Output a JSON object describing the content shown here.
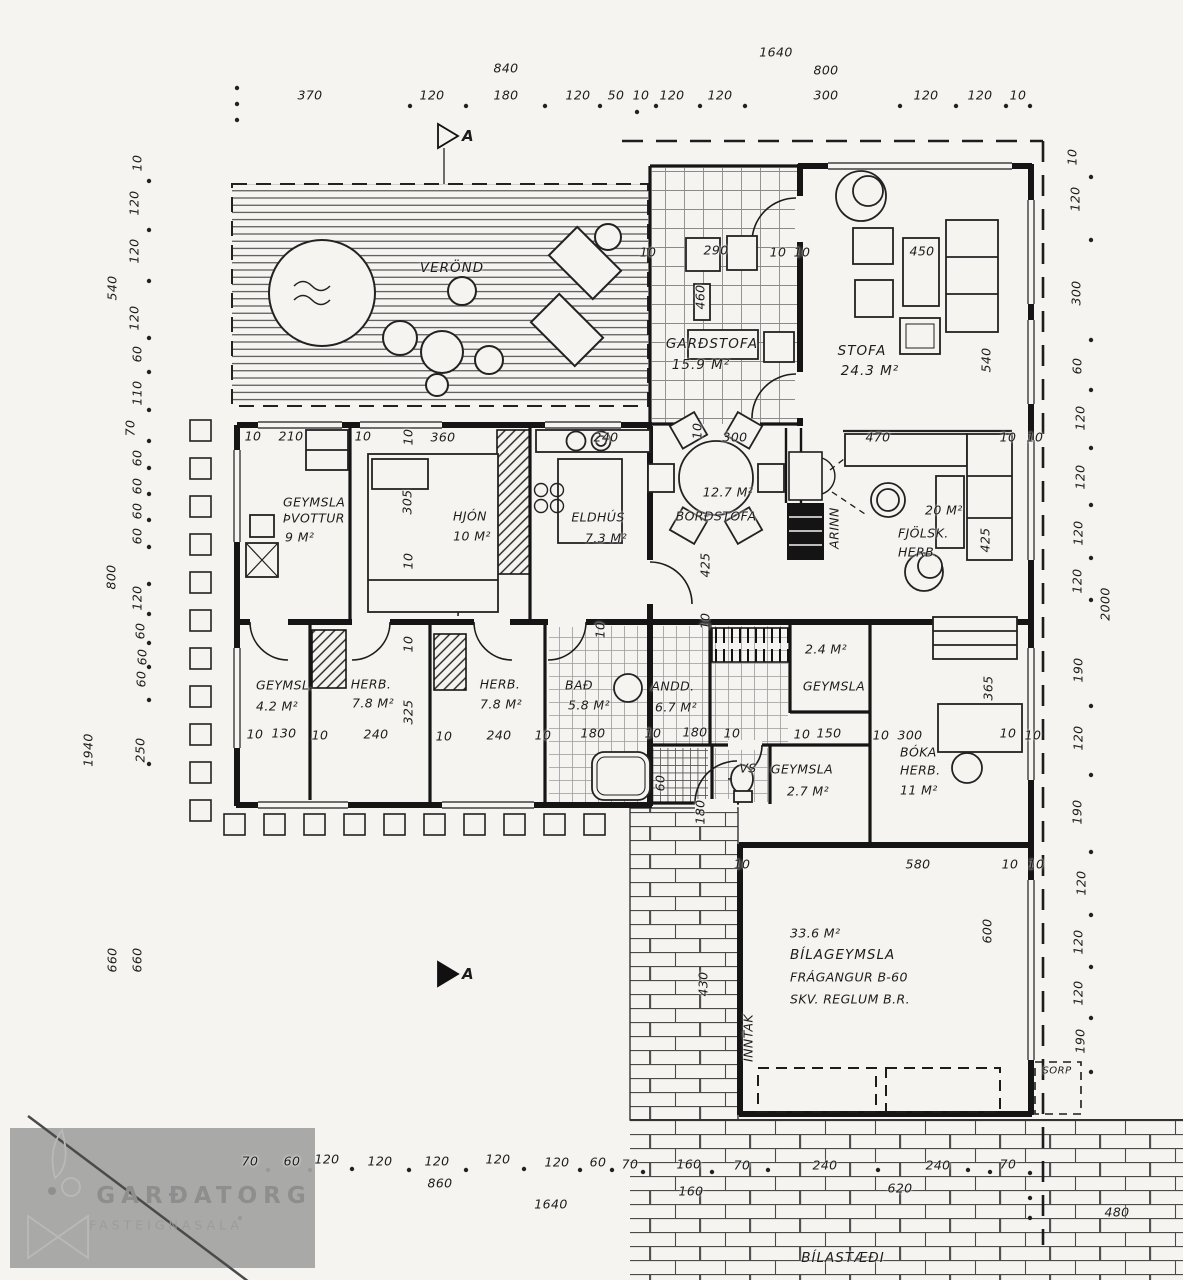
{
  "plan": {
    "section_marker": "A",
    "rooms": {
      "verond": {
        "name": "VERÖND"
      },
      "gardstofa": {
        "name": "GARÐSTOFA",
        "area": "15.9 M²"
      },
      "stofa": {
        "name": "STOFA",
        "area": "24.3 M²"
      },
      "geymsla_thvottur": {
        "name": "GEYMSLA",
        "name2": "ÞVOTTUR",
        "area": "9 M²"
      },
      "hjon": {
        "name": "HJÓN",
        "area": "10 M²"
      },
      "eldhus": {
        "name": "ELDHÚS",
        "area": "7.3 M²"
      },
      "bordstofa": {
        "name": "BORÐSTOFA",
        "area": "12.7 M²"
      },
      "arinn": {
        "name": "ARINN"
      },
      "fjolsk_herb": {
        "name": "FJÖLSK.",
        "name2": "HERB.",
        "area": "20 M²"
      },
      "geymsl_sm": {
        "name": "GEYMSL.",
        "area": "4.2 M²"
      },
      "herb1": {
        "name": "HERB.",
        "area": "7.8 M²"
      },
      "herb2": {
        "name": "HERB.",
        "area": "7.8 M²"
      },
      "bad": {
        "name": "BAÐ",
        "area": "5.8 M²"
      },
      "andd": {
        "name": "ANDD.",
        "area": "6.7 M²"
      },
      "geymsla_24": {
        "name": "GEYMSLA",
        "area": "2.4 M²"
      },
      "vs": {
        "name": "VS"
      },
      "geymsla_27": {
        "name": "GEYMSLA",
        "area": "2.7 M²"
      },
      "boka_herb": {
        "name": "BÓKA",
        "name2": "HERB.",
        "area": "11 M²"
      },
      "bilageymsla": {
        "area": "33.6 M²",
        "name": "BÍLAGEYMSLA",
        "note1": "FRÁGANGUR B-60",
        "note2": "SKV. REGLUM B.R."
      },
      "inntak": {
        "name": "INNTAK"
      },
      "sorp": {
        "name": "SORP"
      },
      "bilastaedi": {
        "name": "BÍLASTÆÐI"
      }
    },
    "dims": {
      "top": [
        "370",
        "120",
        "840",
        "180",
        "120",
        "50",
        "10",
        "120",
        "120",
        "1640",
        "800",
        "300",
        "120",
        "120",
        "10"
      ],
      "left": [
        "10",
        "120",
        "120",
        "540",
        "120",
        "60",
        "110",
        "70",
        "60",
        "60",
        "60",
        "60",
        "800",
        "120",
        "60",
        "60",
        "60",
        "250",
        "1940",
        "660",
        "660"
      ],
      "right": [
        "10",
        "120",
        "300",
        "60",
        "120",
        "120",
        "120",
        "120",
        "2000",
        "190",
        "120",
        "190",
        "120",
        "120",
        "120",
        "190"
      ],
      "mid": [
        "10",
        "210",
        "10",
        "10",
        "360",
        "240",
        "10",
        "300",
        "470",
        "10",
        "10",
        "10",
        "290",
        "10",
        "10",
        "460",
        "450",
        "540",
        "305",
        "10",
        "425",
        "425"
      ],
      "low": [
        "10",
        "130",
        "10",
        "240",
        "10",
        "240",
        "10",
        "180",
        "10",
        "180",
        "10",
        "10",
        "150",
        "10",
        "300",
        "10",
        "10",
        "325",
        "365",
        "60",
        "180",
        "10",
        "10",
        "10"
      ],
      "garage": [
        "10",
        "580",
        "10",
        "10",
        "600",
        "430"
      ],
      "bottom": [
        "70",
        "60",
        "120",
        "120",
        "120",
        "860",
        "120",
        "120",
        "60",
        "70",
        "1640",
        "160",
        "160",
        "70",
        "240",
        "620",
        "240",
        "70",
        "480"
      ]
    }
  },
  "watermark": {
    "brand": "GARÐATORG",
    "tagline": "FASTEIGNASALA"
  },
  "colors": {
    "paper": "#f5f4f1",
    "ink": "#1c1c1c",
    "watermark_box": "#a3a3a3",
    "watermark_text": "#8e8e8e"
  }
}
